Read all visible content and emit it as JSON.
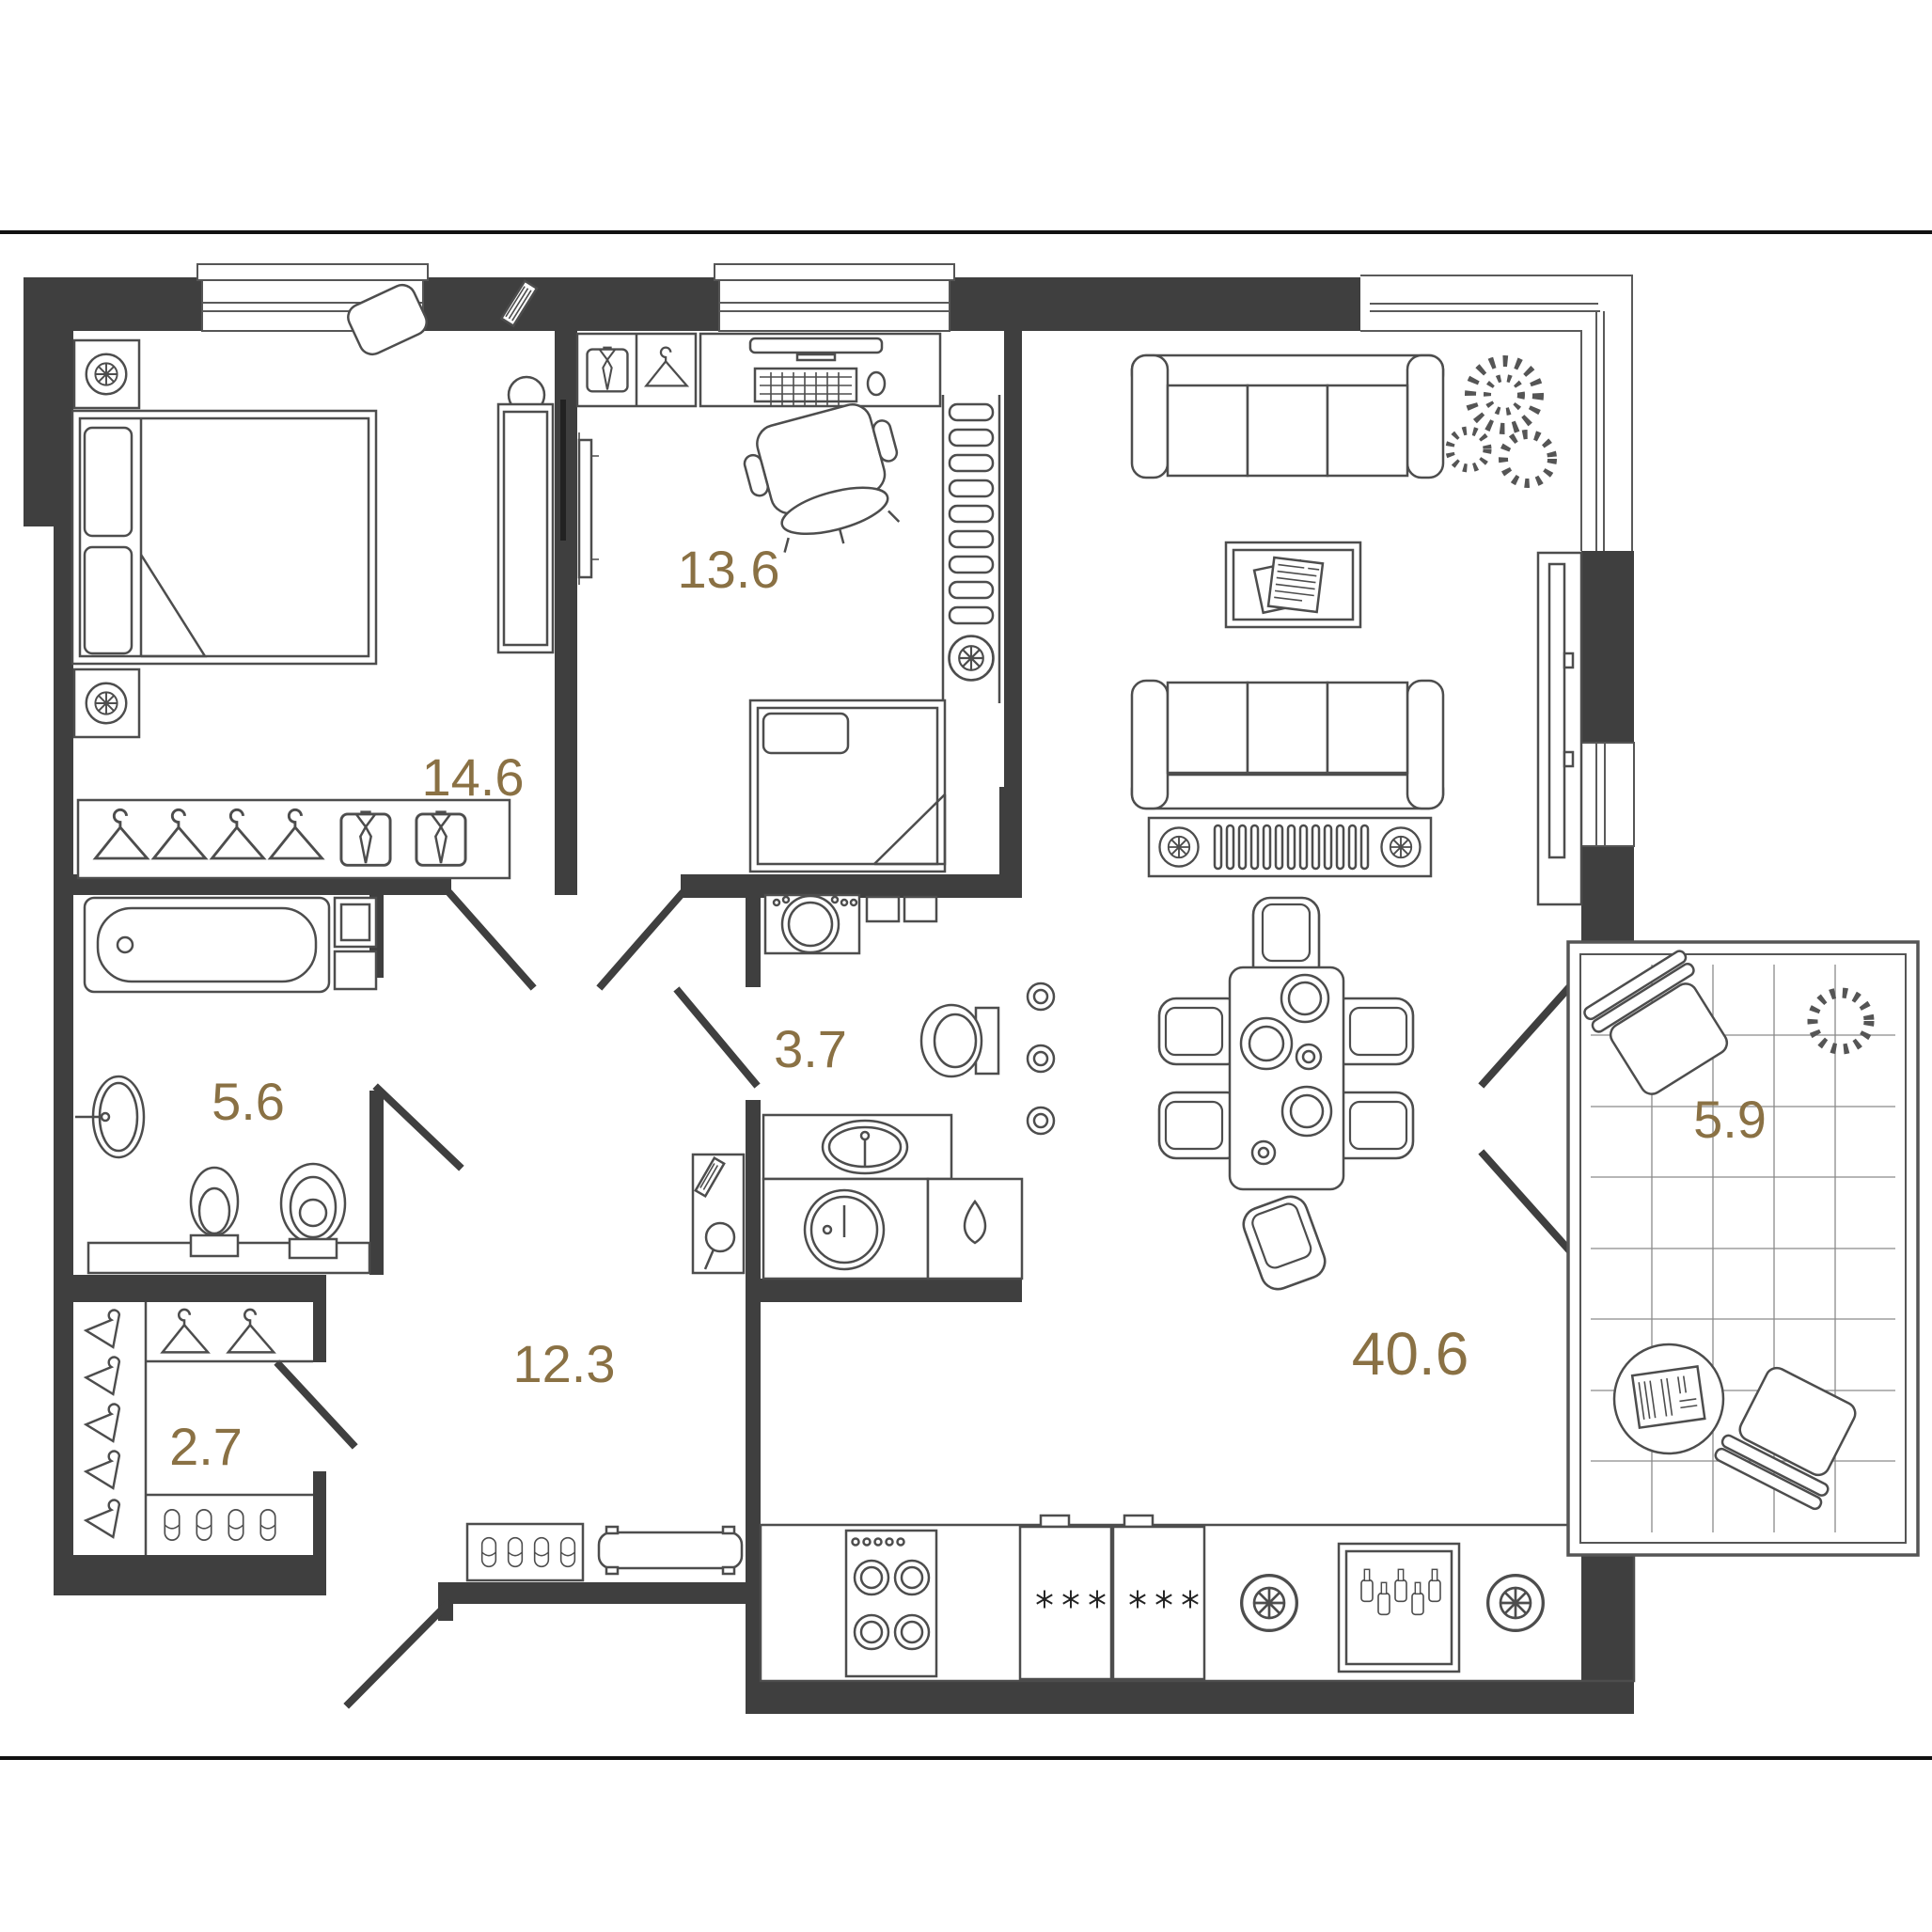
{
  "plan": {
    "rooms": [
      {
        "id": "bedroom",
        "area": "14.6"
      },
      {
        "id": "child-room",
        "area": "13.6"
      },
      {
        "id": "bathroom",
        "area": "5.6"
      },
      {
        "id": "wc",
        "area": "3.7"
      },
      {
        "id": "closet",
        "area": "2.7"
      },
      {
        "id": "hallway",
        "area": "12.3"
      },
      {
        "id": "kitchen-living-room",
        "area": "40.6"
      },
      {
        "id": "balcony",
        "area": "5.9"
      }
    ],
    "colors": {
      "label": "#8a7144",
      "wall": "#3f3f3f",
      "line": "#4d4d4d"
    }
  }
}
